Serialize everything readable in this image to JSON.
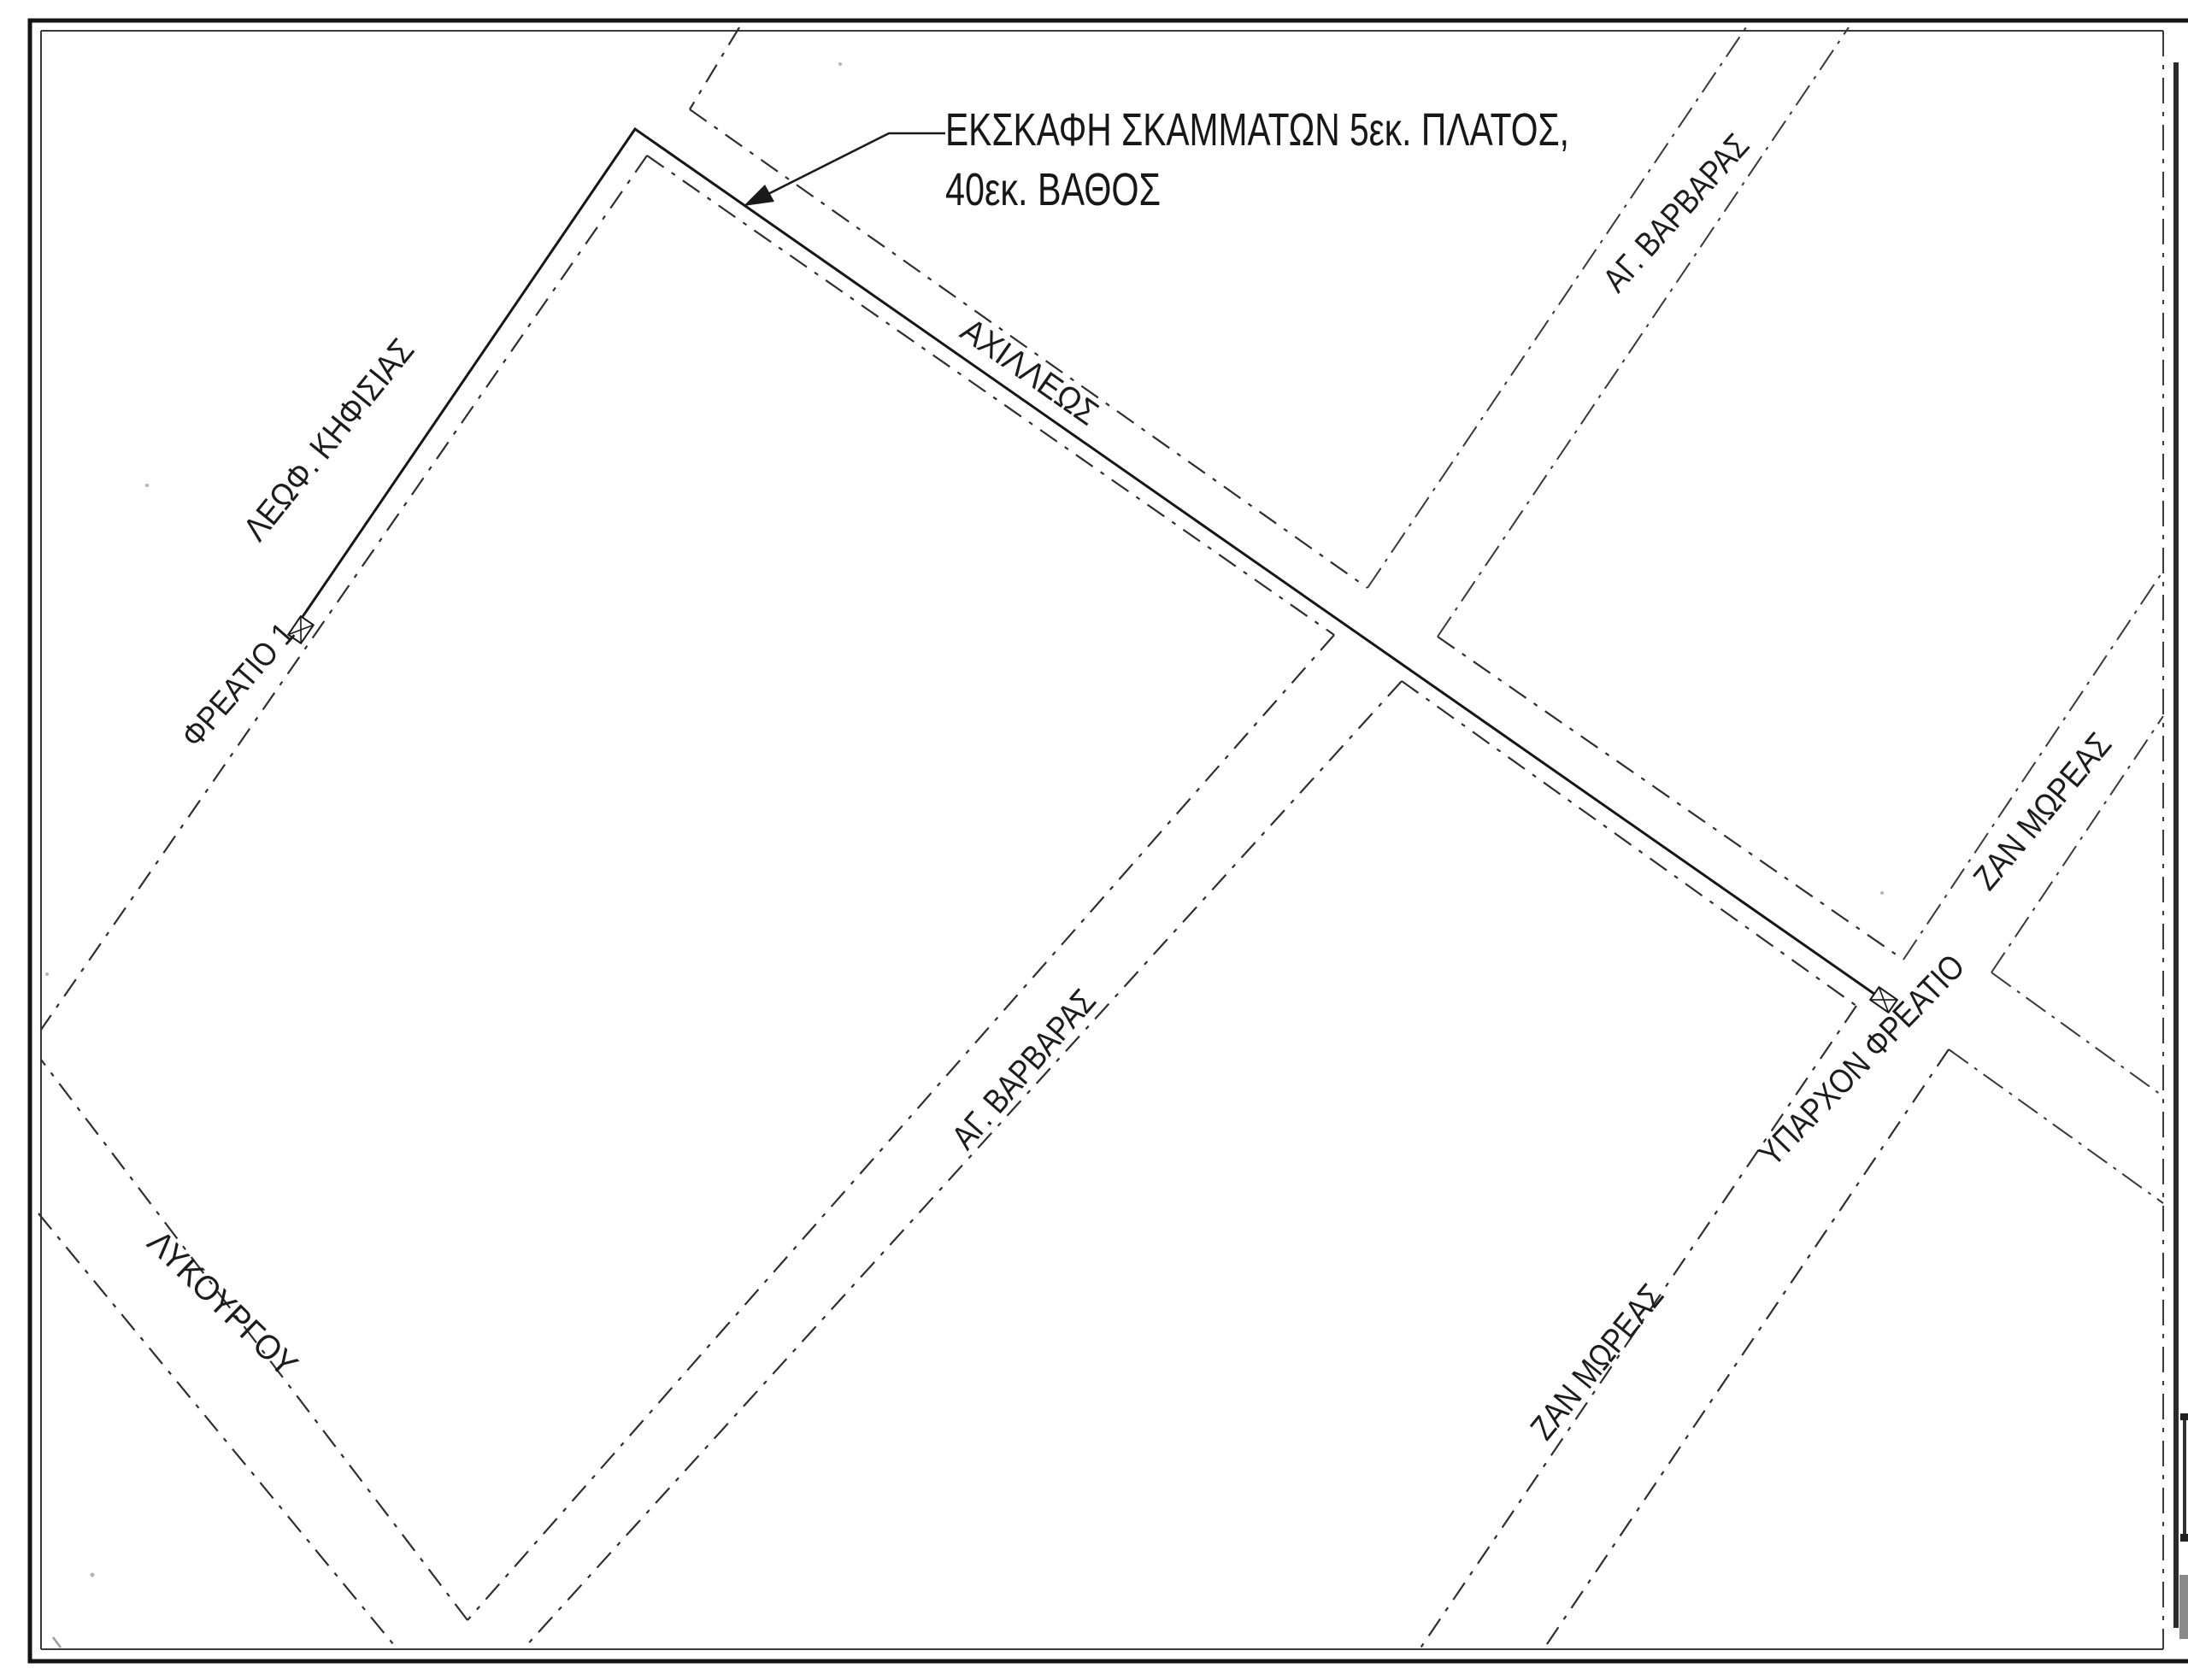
{
  "annotation": {
    "line1": "ΕΚΣΚΑΦΗ ΣΚΑΜΜΑΤΩΝ 5εκ. ΠΛΑΤΟΣ,",
    "line2": "40εκ. ΒΑΘΟΣ"
  },
  "streets": {
    "kifisias": "ΛΕΩΦ. ΚΗΦΙΣΙΑΣ",
    "axilleos": "ΑΧΙΛΛΕΩΣ",
    "ag_varvaras_top": "ΑΓ. ΒΑΡΒΑΡΑΣ",
    "ag_varvaras_mid": "ΑΓ. ΒΑΡΒΑΡΑΣ",
    "zan_moreas_top": "ΖΑΝ ΜΩΡΕΑΣ",
    "zan_moreas_bottom": "ΖΑΝ ΜΩΡΕΑΣ",
    "lykourgou": "ΛΥΚΟΥΡΓΟΥ"
  },
  "manholes": {
    "freatio1": "ΦΡΕΑΤΙΟ 1",
    "existing": "ΥΠΑΡΧΟΝ ΦΡΕΑΤΙΟ"
  },
  "colors": {
    "ink": "#1c1c1c",
    "paper": "#ffffff"
  }
}
